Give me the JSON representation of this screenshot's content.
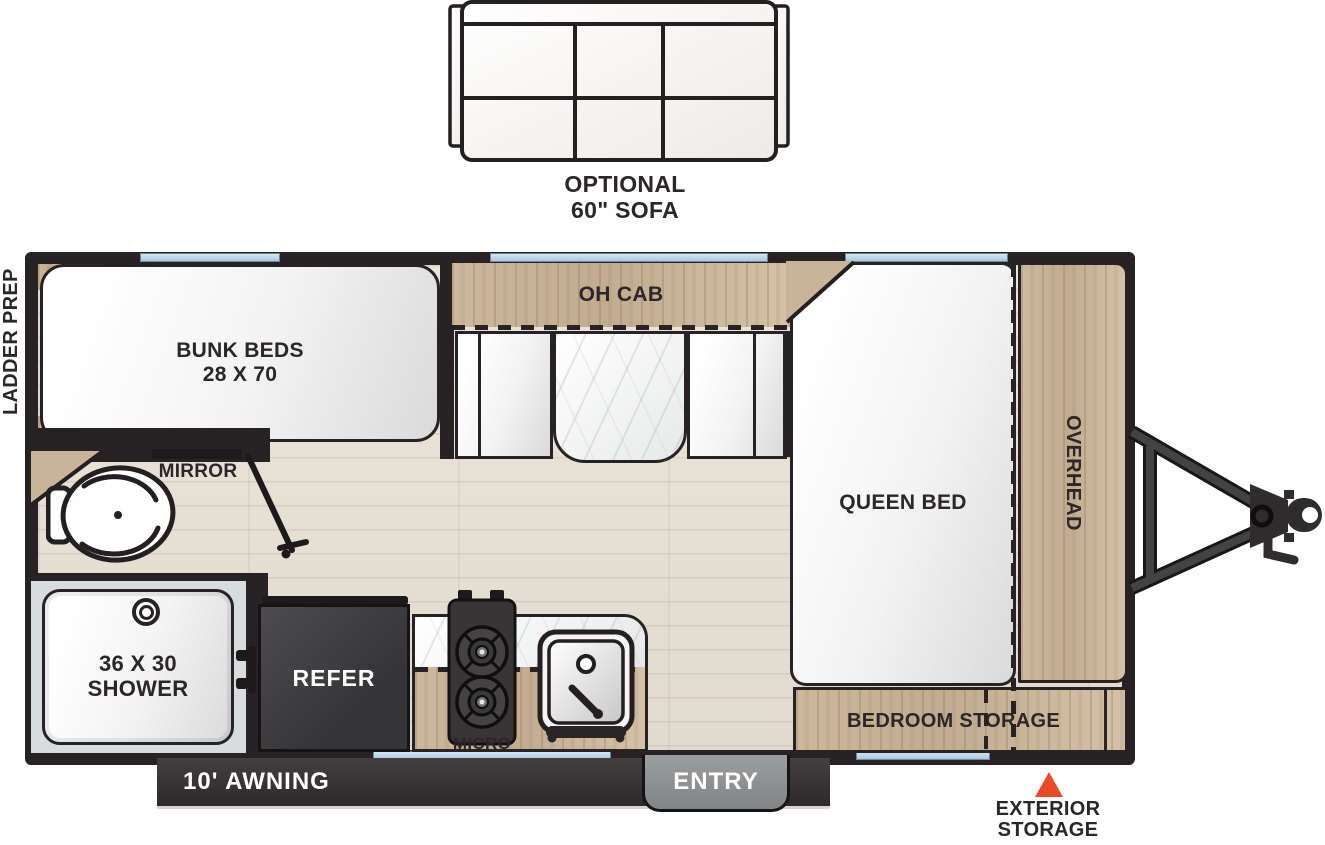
{
  "sofa": {
    "line1": "OPTIONAL",
    "line2": "60\" SOFA"
  },
  "exterior_labels": {
    "ladder_prep": "LADDER PREP",
    "awning": "10' AWNING",
    "entry": "ENTRY",
    "storage_line1": "EXTERIOR",
    "storage_line2": "STORAGE"
  },
  "interior_labels": {
    "bunk_line1": "BUNK BEDS",
    "bunk_line2": "28 X 70",
    "oh_cab": "OH CAB",
    "queen_bed": "QUEEN BED",
    "overhead": "OVERHEAD",
    "bedroom_storage": "BEDROOM STORAGE",
    "mirror": "MIRROR",
    "shower_line1": "36 X 30",
    "shower_line2": "SHOWER",
    "refer": "REFER",
    "micro": "MICRO"
  },
  "colors": {
    "wall": "#272324",
    "text": "#2b2627",
    "wood_a": "#cdb89c",
    "wood_b": "#c2ac8f",
    "wood_c": "#d4c1a6",
    "floor_a": "#eae5da",
    "floor_b": "#e1dbcf",
    "window": "#b9d6ea",
    "accent": "#ea4b27",
    "tab_gray": "#828486",
    "awning_bar": "#2e2a2b",
    "refer_box": "#353537"
  }
}
